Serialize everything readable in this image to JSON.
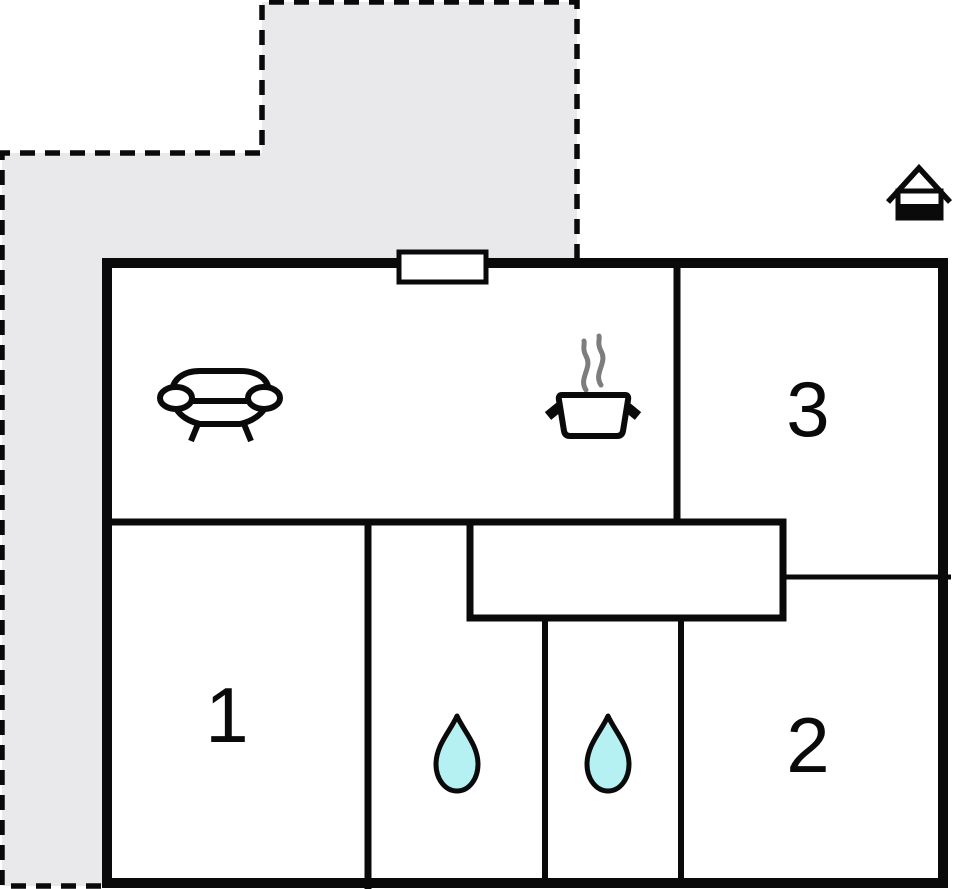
{
  "colors": {
    "wall": "#0a0a0a",
    "floor_fill": "#ffffff",
    "terrace_fill": "#e9e9ec",
    "drop_fill": "#b5f1f3",
    "steam": "#7d7d7d"
  },
  "plan": {
    "rooms": [
      {
        "id": "room-1",
        "label": "1"
      },
      {
        "id": "room-2",
        "label": "2"
      },
      {
        "id": "room-3",
        "label": "3"
      }
    ],
    "icons": [
      "sofa-icon",
      "cooking-pot-icon",
      "steam-icon",
      "water-drop-icon",
      "water-drop-icon",
      "house-icon"
    ]
  }
}
